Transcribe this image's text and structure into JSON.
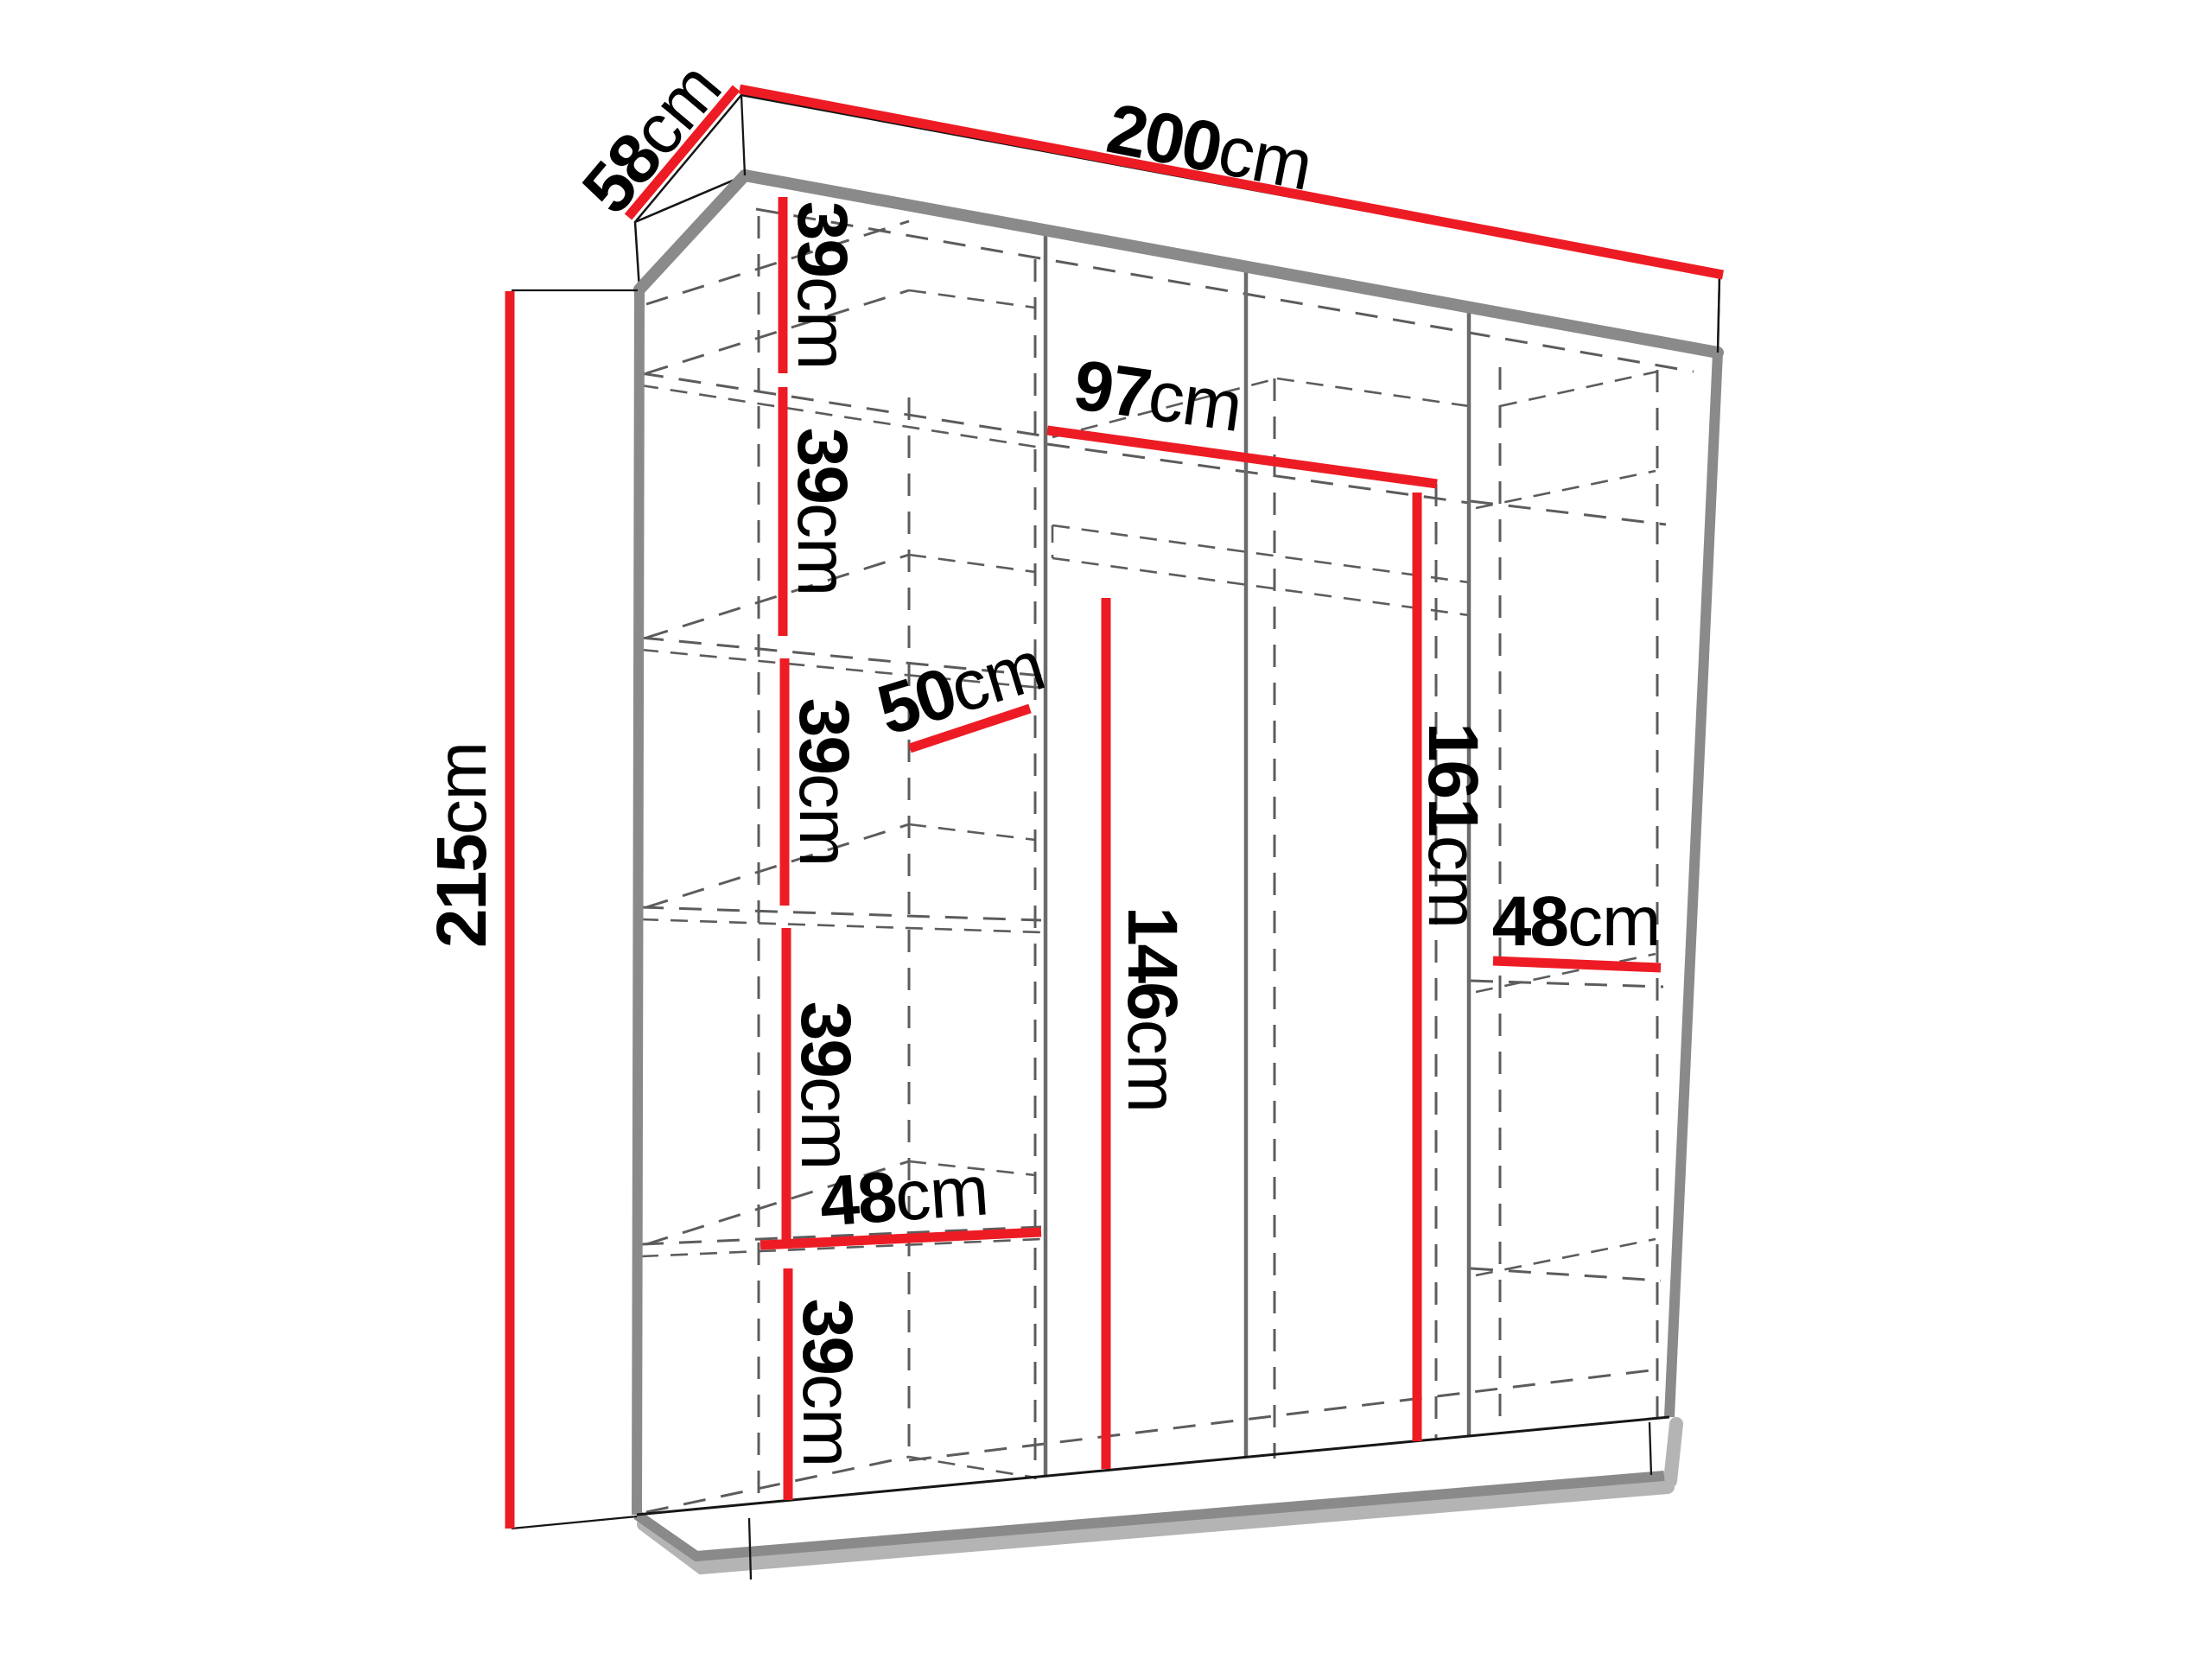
{
  "colors": {
    "red": "#ed1c24",
    "edge_gray": "#8a8a8a",
    "divider_gray": "#6b6b6b",
    "dash_gray": "#5c5c5c",
    "shadow_gray": "#b4b4b4",
    "line_black": "#161616",
    "text_black": "#000000",
    "background": "#ffffff"
  },
  "diagram": {
    "type": "wardrobe-dimension-drawing",
    "dims": {
      "depth": {
        "value": "58",
        "unit": "cm"
      },
      "width": {
        "value": "200",
        "unit": "cm"
      },
      "height": {
        "value": "215",
        "unit": "cm"
      },
      "shelf1": {
        "value": "39",
        "unit": "cm"
      },
      "shelf2": {
        "value": "39",
        "unit": "cm"
      },
      "shelf3": {
        "value": "39",
        "unit": "cm"
      },
      "shelf4": {
        "value": "39",
        "unit": "cm"
      },
      "shelf5": {
        "value": "39",
        "unit": "cm"
      },
      "shelf_depth": {
        "value": "50",
        "unit": "cm"
      },
      "inner_width": {
        "value": "97",
        "unit": "cm"
      },
      "inner_height_left": {
        "value": "146",
        "unit": "cm"
      },
      "inner_height_right": {
        "value": "161",
        "unit": "cm"
      },
      "bottom_width_left": {
        "value": "48",
        "unit": "cm"
      },
      "shelf_width_right": {
        "value": "48",
        "unit": "cm"
      }
    }
  }
}
